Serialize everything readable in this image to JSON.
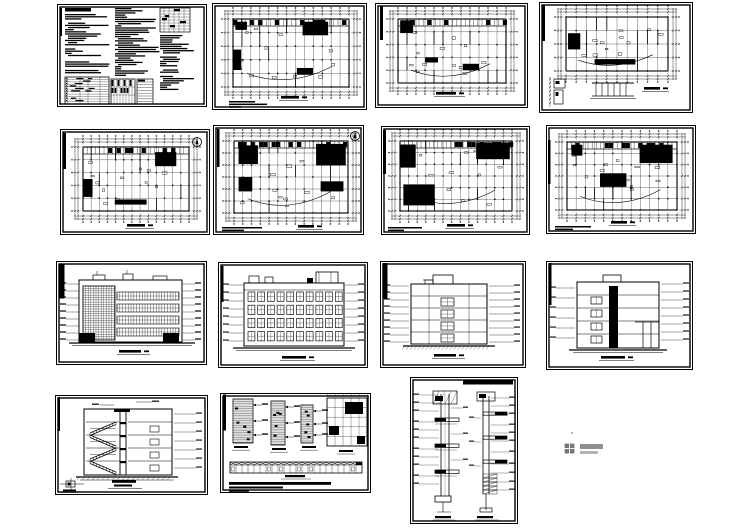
{
  "page": {
    "title": "Collage of 15 architectural CAD drawing sheets on white background",
    "background": "#ffffff",
    "ink": "#000000",
    "sheet_count": 15,
    "text_legible": false
  },
  "sheets": [
    {
      "id": "s1",
      "row": 1,
      "col": 1,
      "kind": "design-notes",
      "label": "design notes sheet with dense specification text columns and schedule tables"
    },
    {
      "id": "s2",
      "row": 1,
      "col": 2,
      "kind": "floor-plan",
      "label": "floor plan sheet with column grid and dimension strings"
    },
    {
      "id": "s3",
      "row": 1,
      "col": 3,
      "kind": "floor-plan",
      "label": "floor plan sheet with title strip at left"
    },
    {
      "id": "s4",
      "row": 1,
      "col": 4,
      "kind": "roof-plan",
      "label": "roof plan sheet with canopy detail at bottom left"
    },
    {
      "id": "s5",
      "row": 2,
      "col": 1,
      "kind": "floor-plan",
      "label": "floor plan sheet with north arrow"
    },
    {
      "id": "s6",
      "row": 2,
      "col": 2,
      "kind": "floor-plan",
      "label": "dense floor plan sheet with north arrow and notes"
    },
    {
      "id": "s7",
      "row": 2,
      "col": 3,
      "kind": "floor-plan",
      "label": "floor plan sheet with notes at bottom left"
    },
    {
      "id": "s8",
      "row": 2,
      "col": 4,
      "kind": "floor-plan",
      "label": "floor plan sheet with notes at bottom left"
    },
    {
      "id": "s9",
      "row": 3,
      "col": 1,
      "kind": "elevation",
      "label": "front elevation sheet with gridded facade"
    },
    {
      "id": "s10",
      "row": 3,
      "col": 2,
      "kind": "elevation",
      "label": "rear elevation sheet with four rows of windows"
    },
    {
      "id": "s11",
      "row": 3,
      "col": 3,
      "kind": "elevation",
      "label": "side elevation sheet with five floor levels"
    },
    {
      "id": "s12",
      "row": 3,
      "col": 4,
      "kind": "section",
      "label": "building cross-section sheet with stair core"
    },
    {
      "id": "s13",
      "row": 4,
      "col": 1,
      "kind": "section",
      "label": "stair section sheet with hatched flights and small detail"
    },
    {
      "id": "s14",
      "row": 4,
      "col": 2,
      "kind": "details",
      "label": "construction details sheet with wall details and long railing strip"
    },
    {
      "id": "s15",
      "row": 4,
      "col": 3,
      "kind": "details",
      "label": "portrait wall-section details sheet with two vertical sections"
    }
  ],
  "watermark": {
    "icon": "pinwheel-diamond",
    "icon_color": "#777777",
    "text_color": "#8f8f8f",
    "legible": false
  }
}
